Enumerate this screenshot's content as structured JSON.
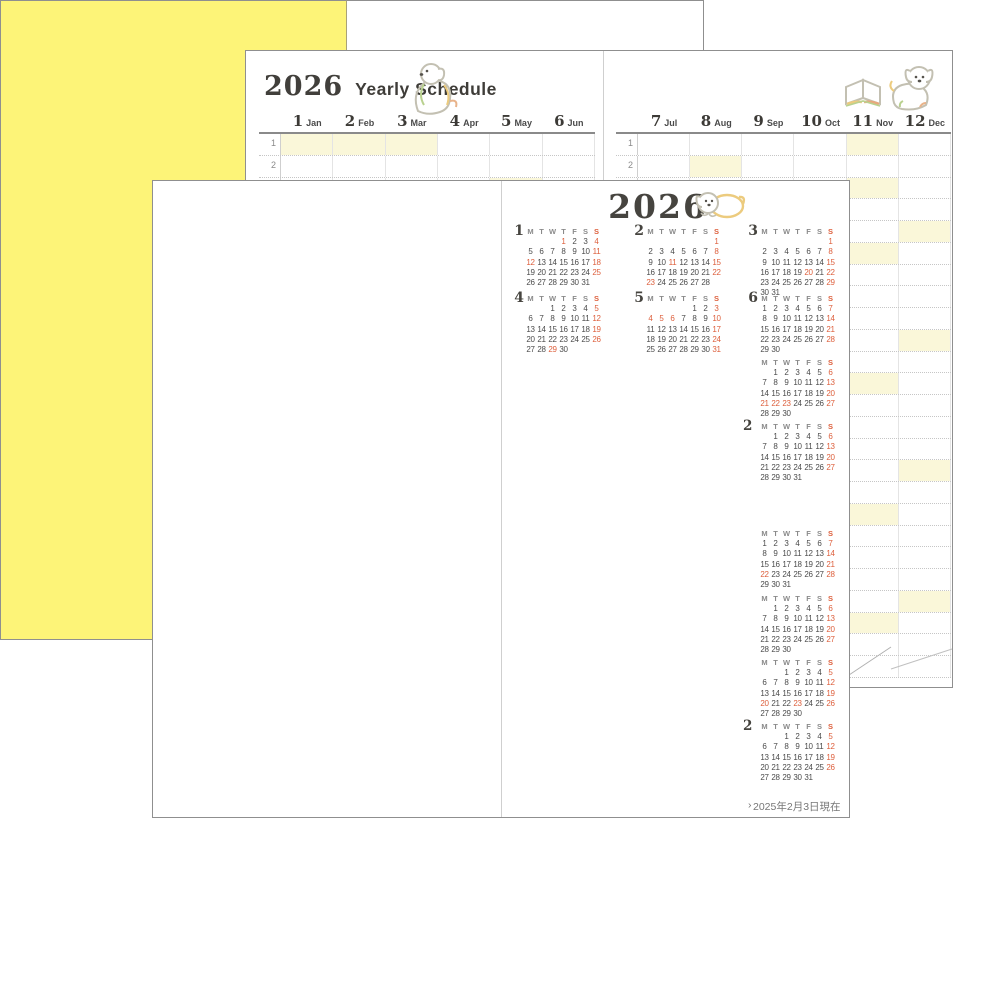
{
  "back_page": {
    "title_year": "2026",
    "title_text": "Yearly Schedule",
    "tables": [
      {
        "months": [
          {
            "num": "1",
            "abbr": "Jan"
          },
          {
            "num": "2",
            "abbr": "Feb"
          },
          {
            "num": "3",
            "abbr": "Mar"
          },
          {
            "num": "4",
            "abbr": "Apr"
          },
          {
            "num": "5",
            "abbr": "May"
          },
          {
            "num": "6",
            "abbr": "Jun"
          }
        ],
        "highlights": [
          {
            "row": 1,
            "col": 0
          },
          {
            "row": 1,
            "col": 1
          },
          {
            "row": 1,
            "col": 2
          },
          {
            "row": 3,
            "col": 4
          }
        ]
      },
      {
        "months": [
          {
            "num": "7",
            "abbr": "Jul"
          },
          {
            "num": "8",
            "abbr": "Aug"
          },
          {
            "num": "9",
            "abbr": "Sep"
          },
          {
            "num": "10",
            "abbr": "Oct"
          },
          {
            "num": "11",
            "abbr": "Nov"
          },
          {
            "num": "12",
            "abbr": "Dec"
          }
        ],
        "highlights": [
          {
            "row": 1,
            "col": 4
          },
          {
            "row": 2,
            "col": 1
          },
          {
            "row": 3,
            "col": 4
          },
          {
            "row": 5,
            "col": 5
          },
          {
            "row": 6,
            "col": 4
          },
          {
            "row": 10,
            "col": 5
          },
          {
            "row": 12,
            "col": 4
          },
          {
            "row": 16,
            "col": 5
          },
          {
            "row": 18,
            "col": 4
          },
          {
            "row": 22,
            "col": 5
          },
          {
            "row": 23,
            "col": 4
          }
        ]
      }
    ],
    "visible_row_labels": [
      "1",
      "2",
      "3"
    ]
  },
  "calendar_page": {
    "year_title": "2026",
    "weekday_header": [
      "M",
      "T",
      "W",
      "T",
      "F",
      "S",
      "S"
    ],
    "note": "2025年2月3日現在",
    "months": [
      {
        "id": "2026-1",
        "num": "1",
        "show_num": true,
        "year": "2026",
        "col": 1,
        "row": 1,
        "weeks": [
          [
            0,
            0,
            0,
            1,
            2,
            3,
            4
          ],
          [
            5,
            6,
            7,
            8,
            9,
            10,
            11
          ],
          [
            12,
            13,
            14,
            15,
            16,
            17,
            18
          ],
          [
            19,
            20,
            21,
            22,
            23,
            24,
            25
          ],
          [
            26,
            27,
            28,
            29,
            30,
            31,
            0
          ]
        ],
        "red": [
          1,
          4,
          11,
          12,
          18,
          25
        ]
      },
      {
        "id": "2026-2",
        "num": "2",
        "show_num": true,
        "year": "2026",
        "col": 2,
        "row": 1,
        "weeks": [
          [
            0,
            0,
            0,
            0,
            0,
            0,
            1
          ],
          [
            2,
            3,
            4,
            5,
            6,
            7,
            8
          ],
          [
            9,
            10,
            11,
            12,
            13,
            14,
            15
          ],
          [
            16,
            17,
            18,
            19,
            20,
            21,
            22
          ],
          [
            23,
            24,
            25,
            26,
            27,
            28,
            0
          ]
        ],
        "red": [
          1,
          8,
          11,
          15,
          22,
          23
        ]
      },
      {
        "id": "2026-3",
        "num": "3",
        "show_num": true,
        "year": "2026",
        "col": 3,
        "row": 1,
        "weeks": [
          [
            0,
            0,
            0,
            0,
            0,
            0,
            1
          ],
          [
            2,
            3,
            4,
            5,
            6,
            7,
            8
          ],
          [
            9,
            10,
            11,
            12,
            13,
            14,
            15
          ],
          [
            16,
            17,
            18,
            19,
            20,
            21,
            22
          ],
          [
            23,
            24,
            25,
            26,
            27,
            28,
            29
          ],
          [
            30,
            31,
            0,
            0,
            0,
            0,
            0
          ]
        ],
        "red": [
          1,
          8,
          15,
          20,
          22,
          29
        ]
      },
      {
        "id": "2026-4",
        "num": "4",
        "show_num": true,
        "year": "2026",
        "col": 1,
        "row": 2,
        "weeks": [
          [
            0,
            0,
            1,
            2,
            3,
            4,
            5
          ],
          [
            6,
            7,
            8,
            9,
            10,
            11,
            12
          ],
          [
            13,
            14,
            15,
            16,
            17,
            18,
            19
          ],
          [
            20,
            21,
            22,
            23,
            24,
            25,
            26
          ],
          [
            27,
            28,
            29,
            30,
            0,
            0,
            0
          ]
        ],
        "red": [
          5,
          12,
          19,
          26,
          29
        ]
      },
      {
        "id": "2026-5",
        "num": "5",
        "show_num": true,
        "year": "2026",
        "col": 2,
        "row": 2,
        "weeks": [
          [
            0,
            0,
            0,
            0,
            1,
            2,
            3
          ],
          [
            4,
            5,
            6,
            7,
            8,
            9,
            10
          ],
          [
            11,
            12,
            13,
            14,
            15,
            16,
            17
          ],
          [
            18,
            19,
            20,
            21,
            22,
            23,
            24
          ],
          [
            25,
            26,
            27,
            28,
            29,
            30,
            31
          ]
        ],
        "red": [
          3,
          4,
          5,
          6,
          10,
          17,
          24,
          31
        ]
      },
      {
        "id": "2026-6",
        "num": "6",
        "show_num": true,
        "year": "2026",
        "col": 3,
        "row": 2,
        "weeks": [
          [
            1,
            2,
            3,
            4,
            5,
            6,
            7
          ],
          [
            8,
            9,
            10,
            11,
            12,
            13,
            14
          ],
          [
            15,
            16,
            17,
            18,
            19,
            20,
            21
          ],
          [
            22,
            23,
            24,
            25,
            26,
            27,
            28
          ],
          [
            29,
            30,
            0,
            0,
            0,
            0,
            0
          ]
        ],
        "red": [
          7,
          14,
          21,
          28
        ]
      },
      {
        "id": "2026-9",
        "num": "9",
        "show_num": false,
        "year": "2026",
        "col": 3,
        "row": 3,
        "weeks": [
          [
            0,
            1,
            2,
            3,
            4,
            5,
            6
          ],
          [
            7,
            8,
            9,
            10,
            11,
            12,
            13
          ],
          [
            14,
            15,
            16,
            17,
            18,
            19,
            20
          ],
          [
            21,
            22,
            23,
            24,
            25,
            26,
            27
          ],
          [
            28,
            29,
            30,
            0,
            0,
            0,
            0
          ]
        ],
        "red": [
          6,
          13,
          20,
          21,
          22,
          23,
          27
        ]
      },
      {
        "id": "2026-12",
        "num": "12",
        "show_num": false,
        "year": "2026",
        "col": 3,
        "row": 4,
        "weeks": [
          [
            0,
            1,
            2,
            3,
            4,
            5,
            6
          ],
          [
            7,
            8,
            9,
            10,
            11,
            12,
            13
          ],
          [
            14,
            15,
            16,
            17,
            18,
            19,
            20
          ],
          [
            21,
            22,
            23,
            24,
            25,
            26,
            27
          ],
          [
            28,
            29,
            30,
            31,
            0,
            0,
            0
          ]
        ],
        "red": [
          6,
          13,
          20,
          27
        ]
      },
      {
        "id": "2027-3",
        "num": "3",
        "show_num": false,
        "year": "2027",
        "col": 3,
        "row": 1,
        "weeks": [
          [
            1,
            2,
            3,
            4,
            5,
            6,
            7
          ],
          [
            8,
            9,
            10,
            11,
            12,
            13,
            14
          ],
          [
            15,
            16,
            17,
            18,
            19,
            20,
            21
          ],
          [
            22,
            23,
            24,
            25,
            26,
            27,
            28
          ],
          [
            29,
            30,
            31,
            0,
            0,
            0,
            0
          ]
        ],
        "red": [
          7,
          14,
          21,
          22,
          28
        ]
      },
      {
        "id": "2027-6",
        "num": "6",
        "show_num": false,
        "year": "2027",
        "col": 3,
        "row": 2,
        "weeks": [
          [
            0,
            1,
            2,
            3,
            4,
            5,
            6
          ],
          [
            7,
            8,
            9,
            10,
            11,
            12,
            13
          ],
          [
            14,
            15,
            16,
            17,
            18,
            19,
            20
          ],
          [
            21,
            22,
            23,
            24,
            25,
            26,
            27
          ],
          [
            28,
            29,
            30,
            0,
            0,
            0,
            0
          ]
        ],
        "red": [
          6,
          13,
          20,
          27
        ]
      },
      {
        "id": "2027-9",
        "num": "9",
        "show_num": false,
        "year": "2027",
        "col": 3,
        "row": 3,
        "weeks": [
          [
            0,
            0,
            1,
            2,
            3,
            4,
            5
          ],
          [
            6,
            7,
            8,
            9,
            10,
            11,
            12
          ],
          [
            13,
            14,
            15,
            16,
            17,
            18,
            19
          ],
          [
            20,
            21,
            22,
            23,
            24,
            25,
            26
          ],
          [
            27,
            28,
            29,
            30,
            0,
            0,
            0
          ]
        ],
        "red": [
          5,
          12,
          19,
          20,
          23,
          26
        ]
      },
      {
        "id": "2027-12",
        "num": "12",
        "show_num": false,
        "year": "2027",
        "col": 3,
        "row": 4,
        "weeks": [
          [
            0,
            0,
            1,
            2,
            3,
            4,
            5
          ],
          [
            6,
            7,
            8,
            9,
            10,
            11,
            12
          ],
          [
            13,
            14,
            15,
            16,
            17,
            18,
            19
          ],
          [
            20,
            21,
            22,
            23,
            24,
            25,
            26
          ],
          [
            27,
            28,
            29,
            30,
            31,
            0,
            0
          ]
        ],
        "red": [
          5,
          12,
          19,
          26
        ]
      }
    ],
    "fragments": [
      {
        "text": "2"
      },
      {
        "text": "2"
      },
      {
        "text": "›"
      }
    ]
  },
  "cover_page": {
    "year": "2026",
    "title": "DATEBOOK",
    "cover_color": "#fdf478",
    "accent_red": "#dd5f3c",
    "highlight_yellow": "#faf7d9"
  }
}
